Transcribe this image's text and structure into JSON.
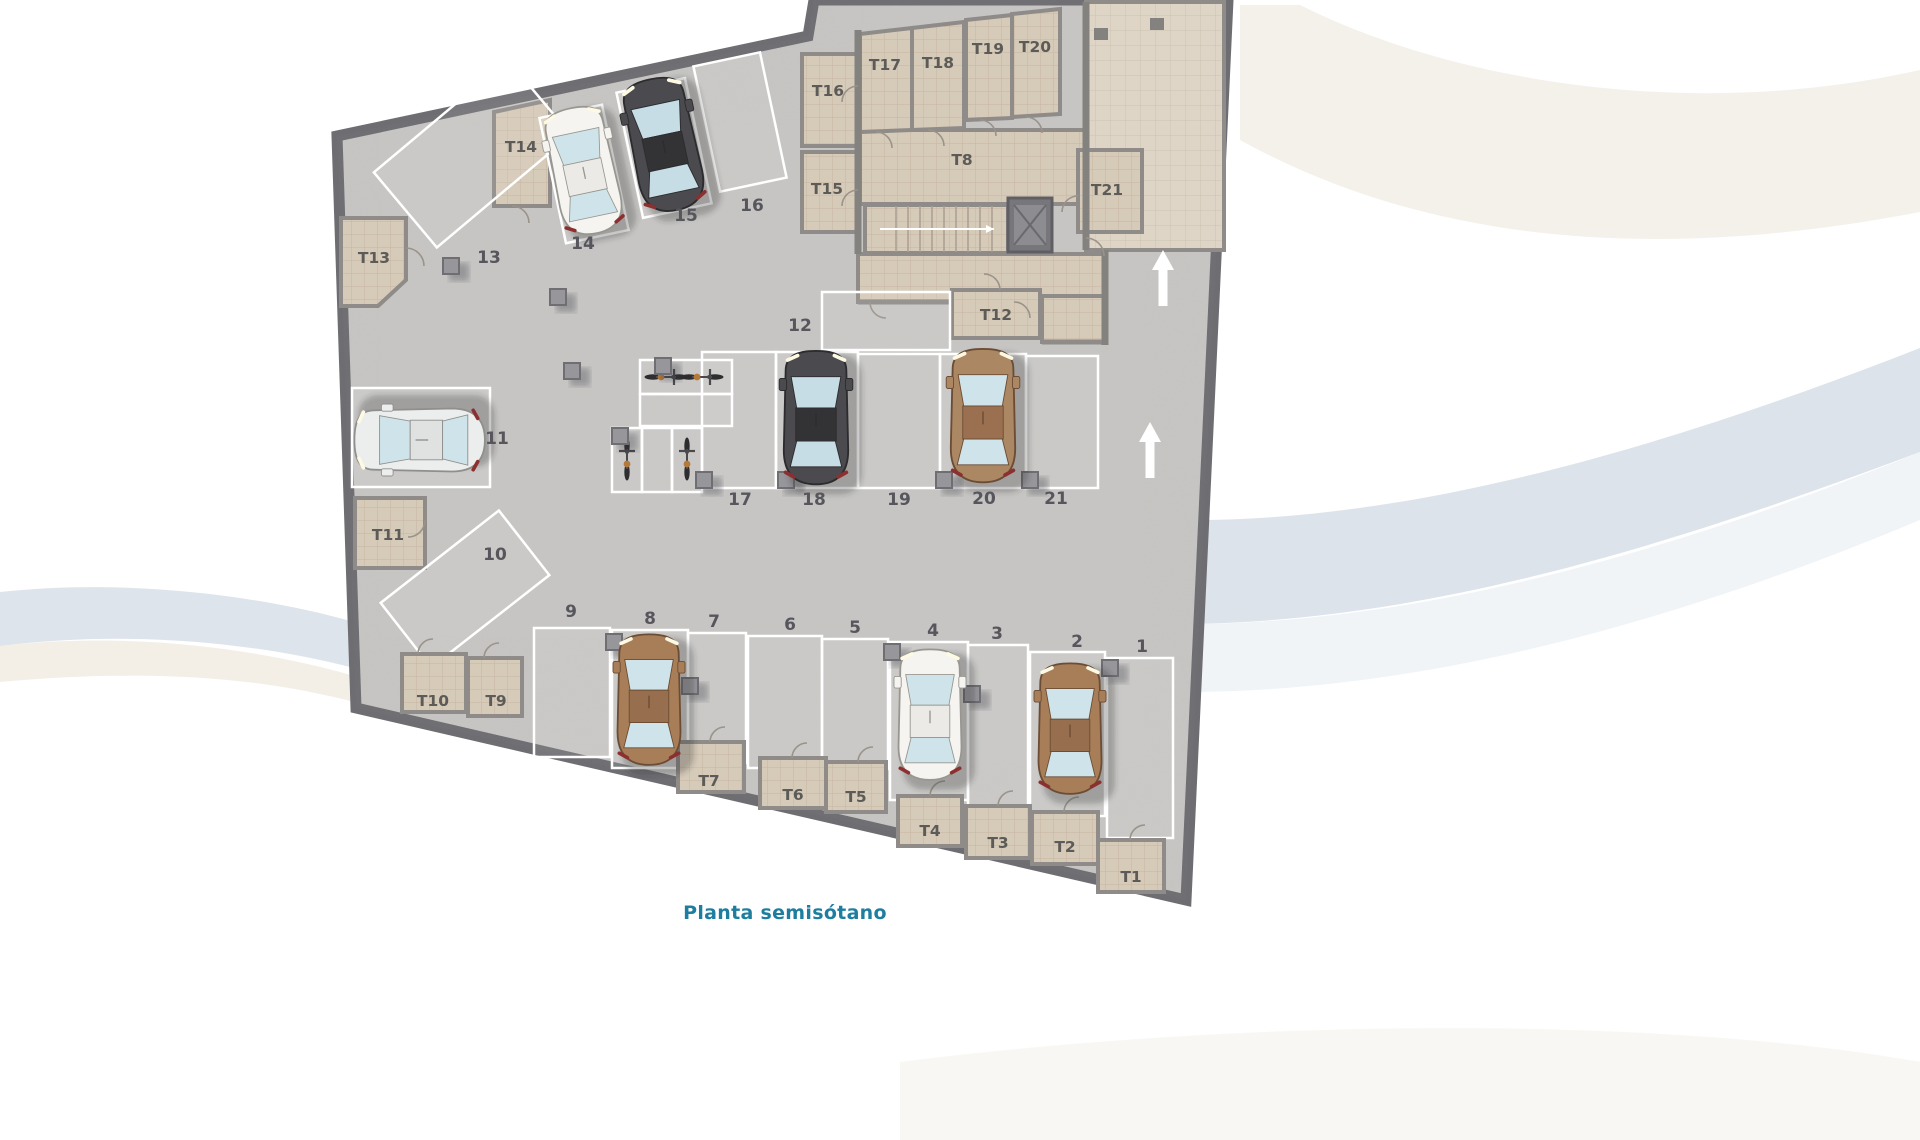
{
  "title": "Planta semisótano",
  "plan": {
    "parking_labels": {
      "p1": "1",
      "p2": "2",
      "p3": "3",
      "p4": "4",
      "p5": "5",
      "p6": "6",
      "p7": "7",
      "p8": "8",
      "p9": "9",
      "p10": "10",
      "p11": "11",
      "p12": "12",
      "p13": "13",
      "p14": "14",
      "p15": "15",
      "p16": "16",
      "p17": "17",
      "p18": "18",
      "p19": "19",
      "p20": "20",
      "p21": "21"
    },
    "storage_labels": {
      "t1": "T1",
      "t2": "T2",
      "t3": "T3",
      "t4": "T4",
      "t5": "T5",
      "t6": "T6",
      "t7": "T7",
      "t8": "T8",
      "t9": "T9",
      "t10": "T10",
      "t11": "T11",
      "t12": "T12",
      "t13": "T13",
      "t14": "T14",
      "t15": "T15",
      "t16": "T16",
      "t17": "T17",
      "t18": "T18",
      "t19": "T19",
      "t20": "T20",
      "t21": "T21"
    }
  },
  "cars": [
    {
      "spot": "14",
      "color": "white"
    },
    {
      "spot": "15",
      "color": "dark-gray"
    },
    {
      "spot": "11",
      "color": "silver"
    },
    {
      "spot": "18",
      "color": "dark-gray"
    },
    {
      "spot": "20",
      "color": "brown"
    },
    {
      "spot": "8",
      "color": "brown"
    },
    {
      "spot": "4",
      "color": "white"
    },
    {
      "spot": "2",
      "color": "brown"
    }
  ],
  "bicycles": {
    "count": 4
  },
  "features": {
    "stairs": true,
    "elevator": true,
    "ramp_arrows_up": 2
  },
  "colors": {
    "title_text": "#1d7e9f",
    "concrete_floor": "#c7c6c4",
    "storage_floor": "#d6cab9",
    "lobby_floor": "#ded5c6",
    "outer_wall": "#6e6d72",
    "inner_wall": "#8e8b88",
    "stall_line": "#ffffff",
    "label_text": "#57565c",
    "car_white": "#f5f4f1",
    "car_dark": "#4b4b4f",
    "car_brown": "#a87e58",
    "ramp_arrow": "#ffffff"
  }
}
